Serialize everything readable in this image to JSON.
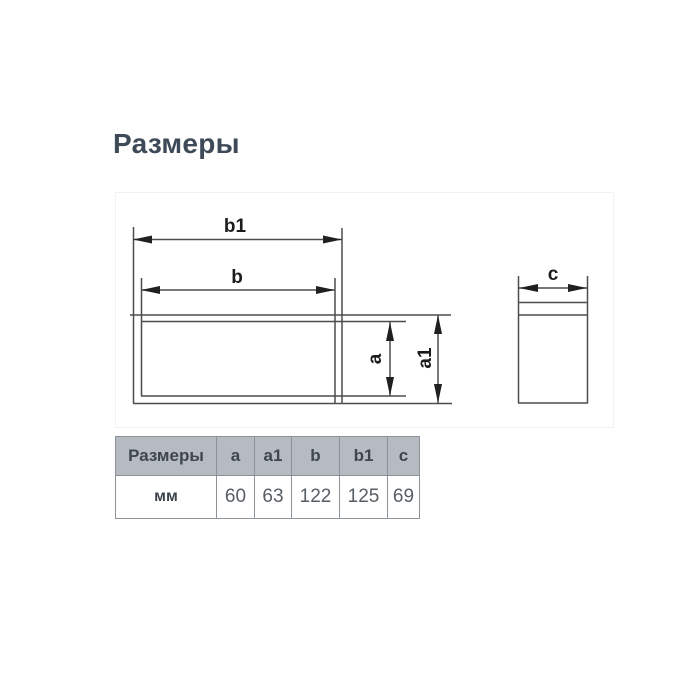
{
  "page": {
    "title": "Размеры",
    "background_color": "#ffffff",
    "title_color": "#3e4a57"
  },
  "drawing": {
    "labels": {
      "b1": "b1",
      "b": "b",
      "a": "a",
      "a1": "a1",
      "c": "c"
    },
    "line_color": "#4d4d4d",
    "arrow_color": "#202020",
    "label_color": "#1c1c1c"
  },
  "table": {
    "headers": [
      "Размеры",
      "a",
      "a1",
      "b",
      "b1",
      "c"
    ],
    "rows": [
      [
        "мм",
        "60",
        "63",
        "122",
        "125",
        "69"
      ]
    ],
    "header_bg": "#b5bbc1",
    "header_text_color": "#3e464e",
    "body_text_color": "#575e64",
    "border_color": "#8b9298"
  }
}
